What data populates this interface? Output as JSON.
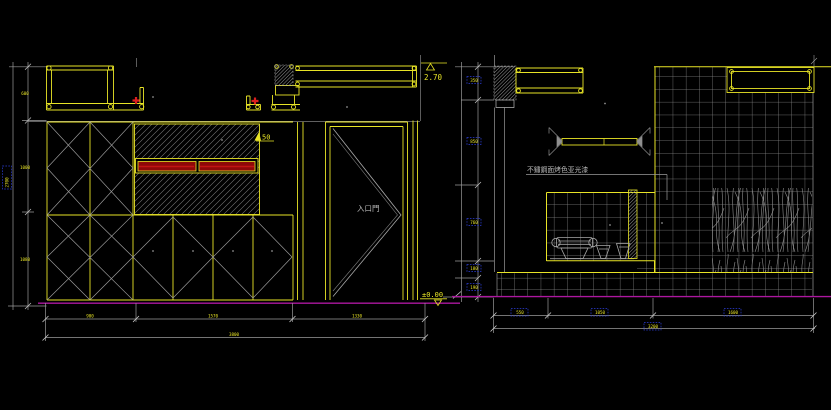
{
  "app": {
    "type": "cad-elevation-drawing",
    "background": "#000000"
  },
  "colors": {
    "line_yellow": "#e8e426",
    "line_gray": "#9a9a9a",
    "tile_gray": "#878787",
    "floor_magenta": "#ad17a0",
    "red_fill": "#8e0808",
    "red_marker": "#dd1f1f",
    "grip_blue": "#2c3ed8",
    "text_gray": "#b9b9b9"
  },
  "left_elevation": {
    "door_label": "入口門",
    "level_top": "2.70",
    "level_floor": "±0.00",
    "handle_note": "50",
    "side_note": "2700",
    "vertical_dims": [
      "600",
      "1000",
      "1080"
    ],
    "bottom_dims": [
      "900",
      "1570",
      "1330"
    ],
    "bottom_total": "3800"
  },
  "right_elevation": {
    "material_note": "不鏽鋼面烤色亚光漆",
    "vertical_dims": [
      "350",
      "850",
      "760",
      "180",
      "190"
    ],
    "bottom_dims": [
      "550",
      "1050",
      "1600"
    ],
    "bottom_total": "3200"
  }
}
